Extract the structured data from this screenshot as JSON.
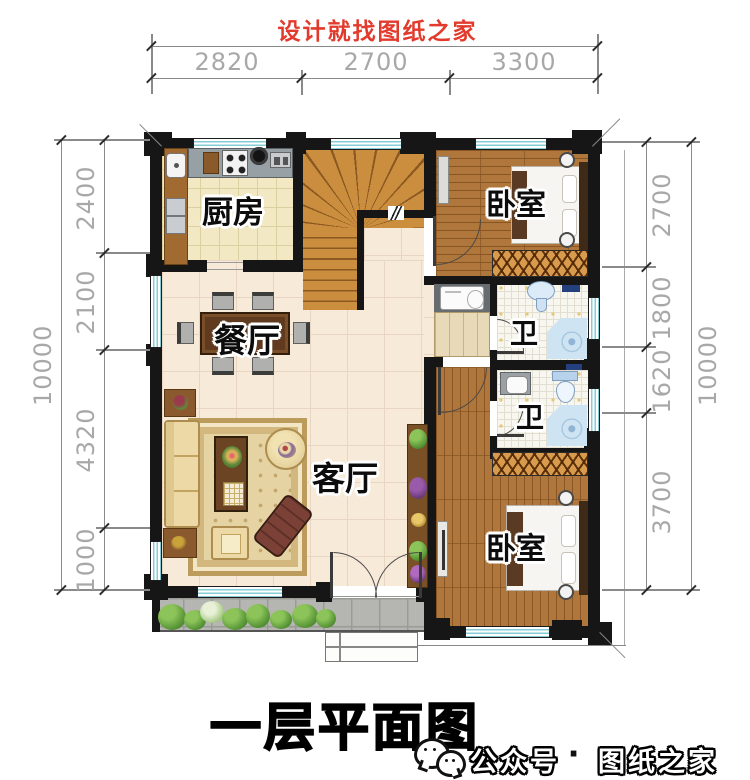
{
  "header": {
    "title": "设计就找图纸之家"
  },
  "plan": {
    "rooms": {
      "kitchen": "厨房",
      "bedroom_top": "卧室",
      "bedroom_bottom": "卧室",
      "dining": "餐厅",
      "living": "客厅",
      "bath_top": "卫",
      "bath_bottom": "卫"
    }
  },
  "dimensions": {
    "top": {
      "segments": [
        "2820",
        "2700",
        "3300"
      ]
    },
    "left": {
      "total": "10000",
      "segments": [
        "2400",
        "2100",
        "4320",
        "1000"
      ]
    },
    "right": {
      "total": "10000",
      "segments": [
        "2700",
        "1800",
        "1620",
        "3700"
      ]
    }
  },
  "footer": {
    "title": "一层平面图",
    "wechat": {
      "icon": "wechat-icon",
      "label": "公众号",
      "separator": "·",
      "brand": "图纸之家"
    }
  },
  "colors": {
    "accent_red": "#e23a2c",
    "wall": "#161616",
    "window": "#86ccd6",
    "wood": "#b0773c"
  }
}
